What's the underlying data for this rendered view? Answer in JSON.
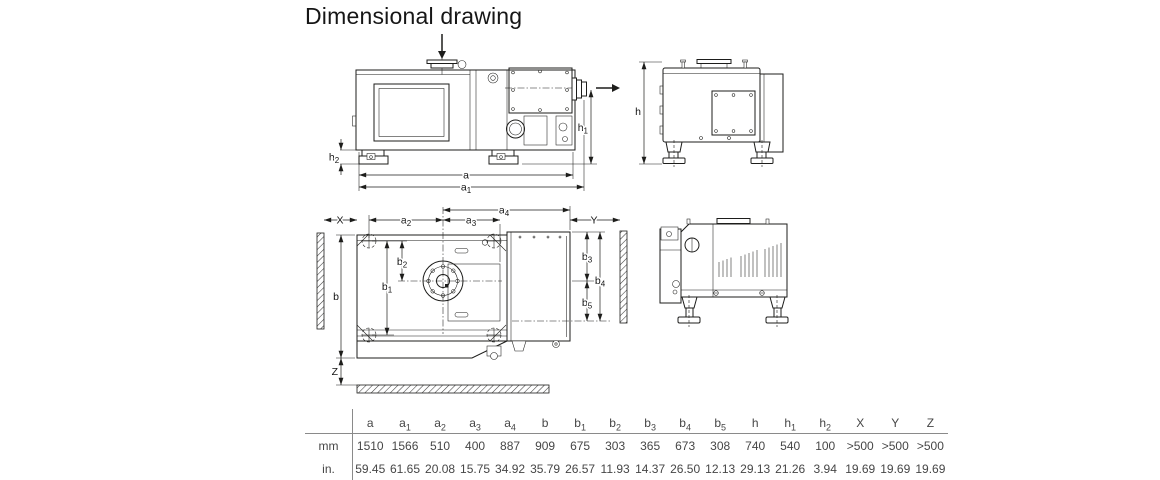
{
  "title": "Dimensional drawing",
  "colors": {
    "line": "#1d1d1b",
    "table_text": "#464646",
    "rule": "#8a8a8a"
  },
  "icons": {
    "inlet_flow": "down-arrow",
    "exhaust_flow": "right-arrow"
  },
  "dims": {
    "a": {
      "base": "a",
      "sub": ""
    },
    "a1": {
      "base": "a",
      "sub": "1"
    },
    "a2": {
      "base": "a",
      "sub": "2"
    },
    "a3": {
      "base": "a",
      "sub": "3"
    },
    "a4": {
      "base": "a",
      "sub": "4"
    },
    "b": {
      "base": "b",
      "sub": ""
    },
    "b1": {
      "base": "b",
      "sub": "1"
    },
    "b2": {
      "base": "b",
      "sub": "2"
    },
    "b3": {
      "base": "b",
      "sub": "3"
    },
    "b4": {
      "base": "b",
      "sub": "4"
    },
    "b5": {
      "base": "b",
      "sub": "5"
    },
    "h": {
      "base": "h",
      "sub": ""
    },
    "h1": {
      "base": "h",
      "sub": "1"
    },
    "h2": {
      "base": "h",
      "sub": "2"
    },
    "X": {
      "base": "X",
      "sub": ""
    },
    "Y": {
      "base": "Y",
      "sub": ""
    },
    "Z": {
      "base": "Z",
      "sub": ""
    }
  },
  "table": {
    "column_keys": [
      "a",
      "a1",
      "a2",
      "a3",
      "a4",
      "b",
      "b1",
      "b2",
      "b3",
      "b4",
      "b5",
      "h",
      "h1",
      "h2",
      "X",
      "Y",
      "Z"
    ],
    "rows": [
      {
        "unit": "mm",
        "values": [
          "1510",
          "1566",
          "510",
          "400",
          "887",
          "909",
          "675",
          "303",
          "365",
          "673",
          "308",
          "740",
          "540",
          "100",
          ">500",
          ">500",
          ">500"
        ]
      },
      {
        "unit": "in.",
        "values": [
          "59.45",
          "61.65",
          "20.08",
          "15.75",
          "34.92",
          "35.79",
          "26.57",
          "11.93",
          "14.37",
          "26.50",
          "12.13",
          "29.13",
          "21.26",
          "3.94",
          "19.69",
          "19.69",
          "19.69"
        ]
      }
    ]
  }
}
